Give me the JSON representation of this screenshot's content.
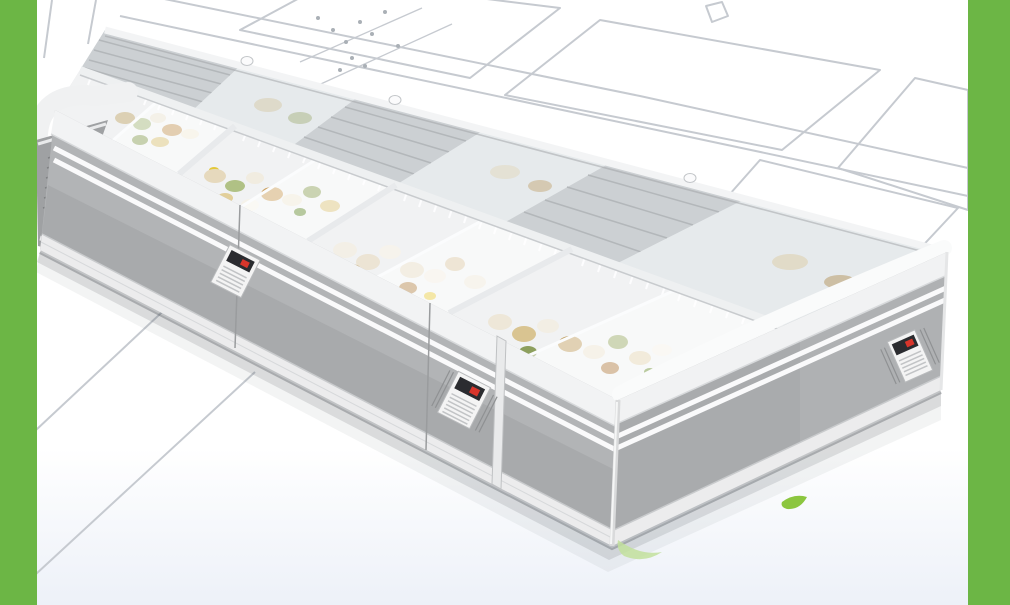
{
  "page": {
    "description": "Product photo of a supermarket island display freezer combination with curved sliding glass lids, shown over a white background with a faint technical wireframe drawing of the same freezer and green vertical accent bars on both edges"
  },
  "colors": {
    "accent_green": "#6cb645",
    "leaf_green": "#8cc63f",
    "leaf_light": "#c2e09c",
    "front_gray": "#b2b4b6",
    "end_gray": "#a9abad",
    "far_end_gray": "#9fa1a3",
    "trim_white": "#f2f3f4",
    "bumper_white": "#ececed",
    "mesh_gray": "#ccd0d3",
    "glass_tint": "#e6eaec",
    "basket_white": "#f1f2f3",
    "wireframe_gray": "#c6cad0",
    "display_dark": "#2b2c30",
    "display_red": "#d8352b",
    "shadow_gray": "#5a5f66",
    "food": [
      "#e6d9bd",
      "#cda263",
      "#94a765",
      "#f1ece0",
      "#dcc783",
      "#b98f58",
      "#6f923f",
      "#e9cf4e"
    ]
  },
  "scene": {
    "subject": "island display freezer combination",
    "visible_units": 2,
    "open_lid_bays_with_baskets": 4,
    "mesh_grille_panels": 3,
    "temperature_control_panels": 3,
    "leaf_accents": 2
  }
}
